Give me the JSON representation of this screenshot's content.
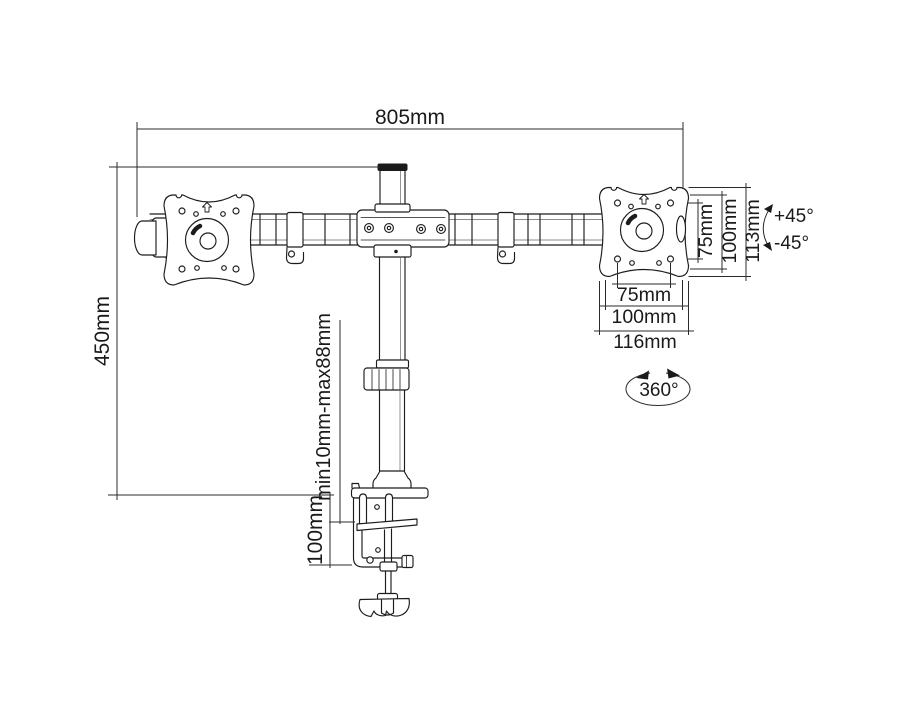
{
  "labels": {
    "arm_span": "805mm",
    "pole_height": "450mm",
    "clamp_range": "min10mm-max88mm",
    "clamp_depth": "100mm",
    "vesa_vertical_inner": "75mm",
    "vesa_vertical_outer": "100mm",
    "plate_height": "113mm",
    "vesa_horizontal_inner": "75mm",
    "vesa_horizontal_outer": "100mm",
    "plate_width": "116mm",
    "tilt_up": "+45°",
    "tilt_down": "-45°",
    "swivel": "360°"
  },
  "colors": {
    "line": "#1c1c1c",
    "dimension_line": "#2b2b2b",
    "background": "#ffffff"
  }
}
